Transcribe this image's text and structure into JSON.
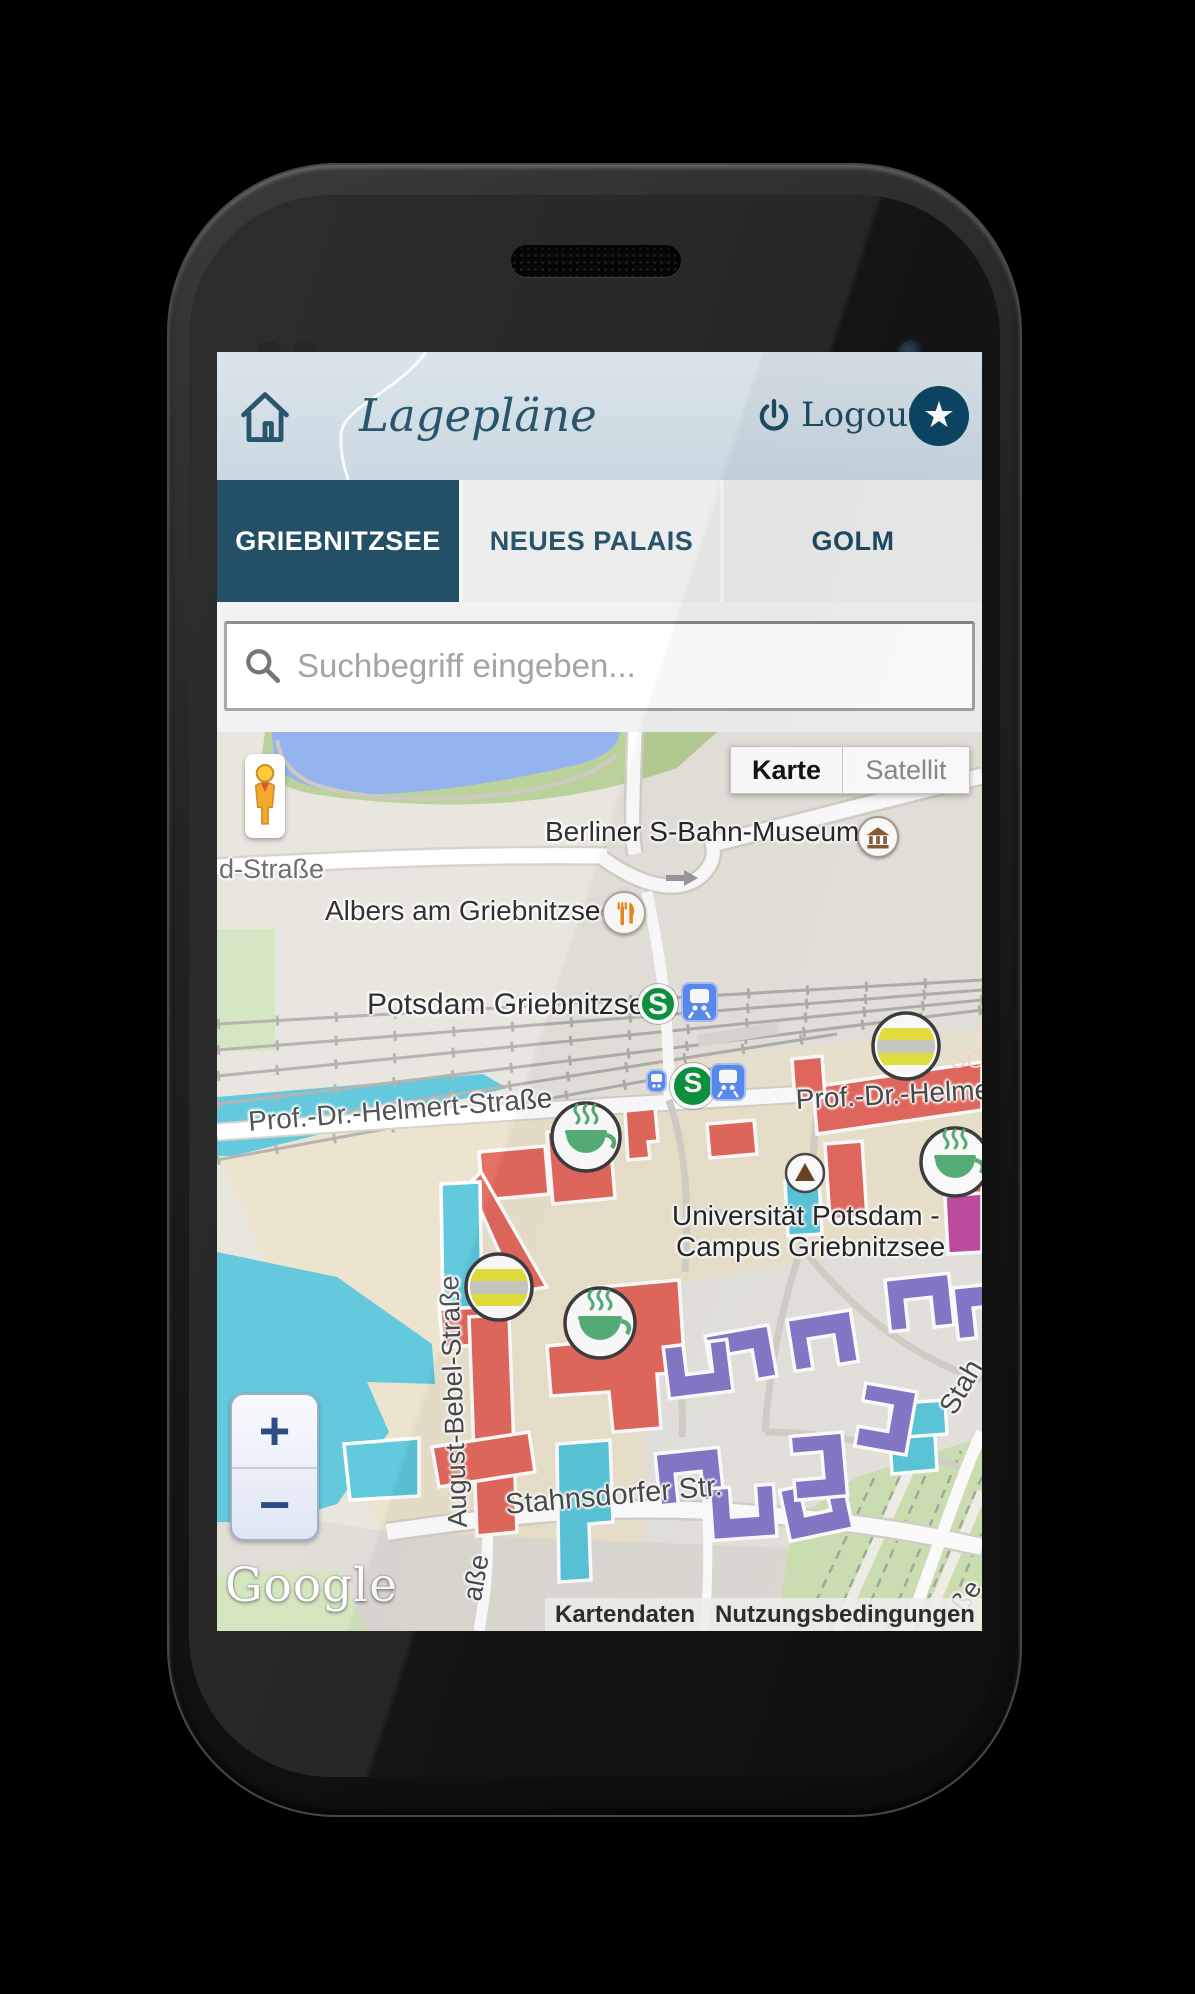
{
  "app": {
    "header": {
      "title": "Lagepläne",
      "logout": "Logout",
      "star_glyph": "★"
    },
    "tabs": [
      {
        "label": "GRIEBNITZSEE",
        "active": true
      },
      {
        "label": "NEUES PALAIS",
        "active": false
      },
      {
        "label": "GOLM",
        "active": false
      }
    ],
    "search": {
      "placeholder": "Suchbegriff eingeben..."
    }
  },
  "map": {
    "controls": {
      "map_type": [
        {
          "label": "Karte",
          "active": true
        },
        {
          "label": "Satellit",
          "active": false
        }
      ],
      "zoom_in": "+",
      "zoom_out": "−"
    },
    "transit": {
      "sbahn_letter": "S"
    },
    "labels": {
      "museum": "Berliner S-Bahn-Museum",
      "restaurant": "Albers am Griebnitzsee",
      "station": "Potsdam Griebnitzsee",
      "street_partial_left": "d-Straße",
      "helmert_left": "Prof.-Dr.-Helmert-Straße",
      "helmert_right": "Prof.-Dr.-Helmert-S",
      "so_fragment": "SO-",
      "university_1": "Universität Potsdam -",
      "university_2": "Campus Griebnitzsee",
      "bebel": "August-Bebel-Straße",
      "stahnsdorfer": "Stahnsdorfer Str.",
      "stah_fragment": "Stah",
      "asse_fragment": "aße",
      "sse_fragment": "ße"
    },
    "attribution": {
      "brand": "Google",
      "kartendaten": "Kartendaten",
      "nutzungsbedingungen": "Nutzungsbedingungen"
    },
    "colors": {
      "header_teal": "#1d4b63",
      "active_tab": "#16455e",
      "water_lake": "#8fb0ee",
      "water_canal": "#5bc6da",
      "building_red": "#e4695e",
      "building_cyan": "#5bc6da",
      "building_purple": "#8679ca",
      "building_magenta": "#bf4da1",
      "marker_green": "#57b078",
      "marker_yellow": "#e6e23e",
      "sbahn_green": "#0d9440",
      "train_blue": "#5a8cf2"
    }
  }
}
